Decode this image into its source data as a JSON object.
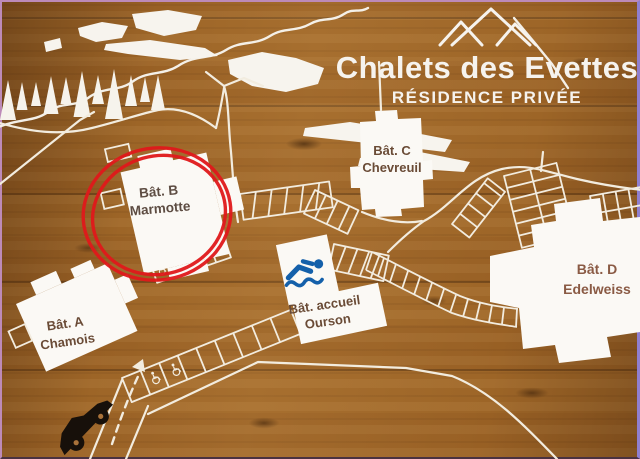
{
  "sign": {
    "title": "Chalets des Evettes",
    "subtitle": "RÉSIDENCE PRIVÉE",
    "logo": "three-mountain-peaks"
  },
  "buildings": {
    "a": {
      "line1": "Bât. A",
      "line2": "Chamois"
    },
    "b": {
      "line1": "Bât. B",
      "line2": "Marmotte"
    },
    "c": {
      "line1": "Bât. C",
      "line2": "Chevreuil"
    },
    "d": {
      "line1": "Bât. D",
      "line2": "Edelweiss"
    },
    "accueil": {
      "line1": "Bât. accueil",
      "line2": "Ourson"
    }
  },
  "annotation": {
    "type": "hand-drawn double red circle",
    "highlights": "Bât. B Marmotte",
    "color": "#e0191b"
  },
  "icons": {
    "swimmer": "swimming-pool at Bât. accueil Ourson",
    "wheelchair": "accessible parking spaces",
    "car": "car at entrance access road",
    "mountains": "mountain peaks logo",
    "pines": "pine tree forest decoration"
  },
  "colors": {
    "wood_brown": "#9d6527",
    "map_white": "#f2ecdf",
    "building_fill": "#fbf9f5",
    "label_brown": "#6a4b36",
    "label_brown_warm": "#8a5a44",
    "swimmer_blue": "#1460aa",
    "annotation_red": "#e0191b",
    "car_black": "#17100a"
  }
}
